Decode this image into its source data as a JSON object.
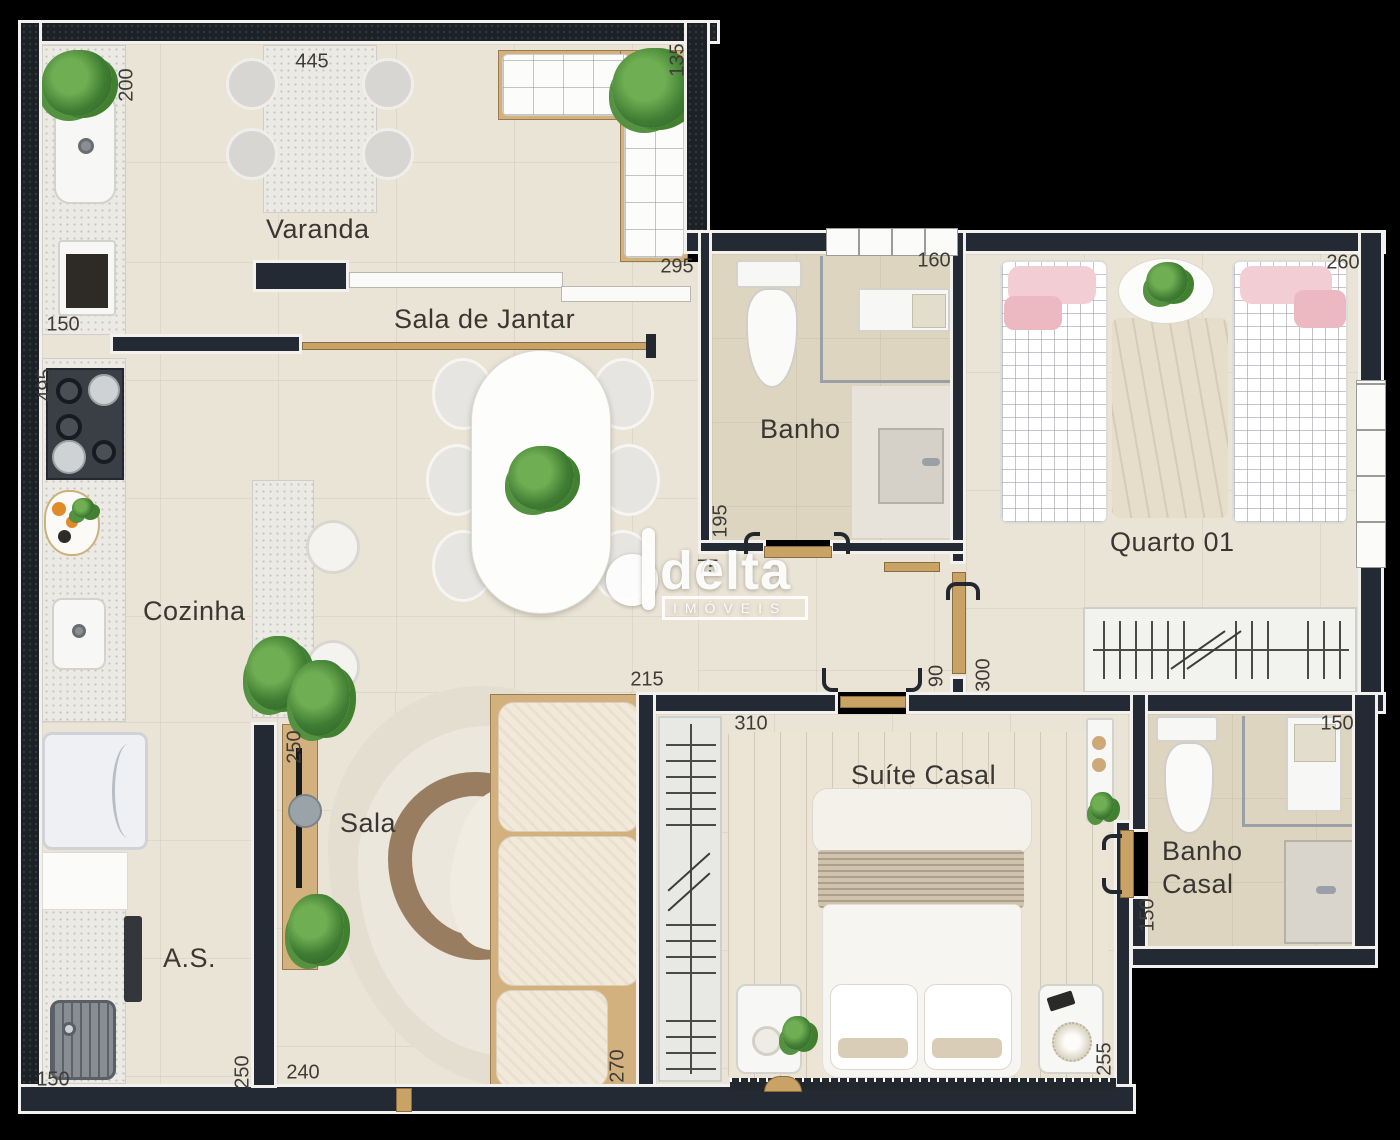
{
  "plan_title": "Apartment floor plan",
  "rooms": {
    "varanda": {
      "label": "Varanda"
    },
    "sala_de_jantar": {
      "label": "Sala de Jantar"
    },
    "banho": {
      "label": "Banho"
    },
    "quarto_01": {
      "label": "Quarto 01"
    },
    "cozinha": {
      "label": "Cozinha"
    },
    "sala": {
      "label": "Sala"
    },
    "suite_casal": {
      "label": "Suíte Casal"
    },
    "banho_casal": {
      "label": "Banho\nCasal"
    },
    "area_servico": {
      "label": "A.S."
    }
  },
  "dims": [
    {
      "value": "200",
      "along": "varanda-left"
    },
    {
      "value": "445",
      "along": "varanda-top"
    },
    {
      "value": "135",
      "along": "varanda-right"
    },
    {
      "value": "295",
      "along": "varanda-bottom"
    },
    {
      "value": "150",
      "along": "varanda-counter"
    },
    {
      "value": "495",
      "along": "cozinha-left"
    },
    {
      "value": "160",
      "along": "banho-top"
    },
    {
      "value": "260",
      "along": "quarto-01-top"
    },
    {
      "value": "195",
      "along": "banho-left"
    },
    {
      "value": "75",
      "along": "hall"
    },
    {
      "value": "215",
      "along": "sala-top"
    },
    {
      "value": "90",
      "along": "hall-door"
    },
    {
      "value": "300",
      "along": "quarto-01-left"
    },
    {
      "value": "310",
      "along": "suite-top"
    },
    {
      "value": "250",
      "along": "sala-left-upper"
    },
    {
      "value": "150",
      "along": "banho-casal-top"
    },
    {
      "value": "150",
      "along": "banho-casal-left"
    },
    {
      "value": "255",
      "along": "suite-right"
    },
    {
      "value": "270",
      "along": "sala-right"
    },
    {
      "value": "240",
      "along": "sala-bottom"
    },
    {
      "value": "250",
      "along": "as-right"
    },
    {
      "value": "150",
      "along": "as-bottom"
    }
  ],
  "watermark": {
    "brand": "delta",
    "tagline": "IMÓVEIS"
  },
  "palette": {
    "background": "#000000",
    "wall": "#232a33",
    "wall_outline": "#f2f1ed",
    "floor": "#eae4d6",
    "bath_floor": "#ded5c1",
    "wood_door": "#c9a265",
    "label_text": "#3a3733",
    "plant_green": "#4c8a3a",
    "pink_bedding": "#f2cdd3"
  }
}
